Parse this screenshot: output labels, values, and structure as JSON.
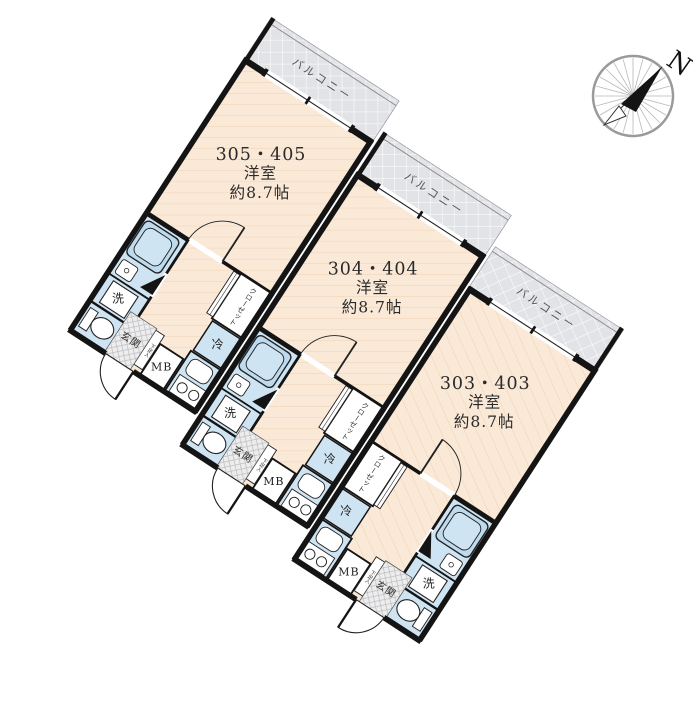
{
  "compass": {
    "n": "N"
  },
  "labels": {
    "balcony": "バルコニー",
    "washer": "洗",
    "fridge": "冷",
    "closet": "クローゼット",
    "entrance": "玄関",
    "shoe_box": "下足入",
    "meter_box": "MB"
  },
  "units": [
    {
      "number": "305・405",
      "type": "洋室",
      "size": "約8.7帖"
    },
    {
      "number": "304・404",
      "type": "洋室",
      "size": "約8.7帖"
    },
    {
      "number": "303・403",
      "type": "洋室",
      "size": "約8.7帖"
    }
  ],
  "colors": {
    "wall": "#1a1a1a",
    "floor": "#fbe9d8",
    "floor_line": "#eccfae",
    "fixture_blue": "#cfe4f2",
    "tub_blue": "#bddaee",
    "balcony_gray": "#e2e3e7",
    "entrance_hatch": "#ededee",
    "text": "#333333"
  }
}
